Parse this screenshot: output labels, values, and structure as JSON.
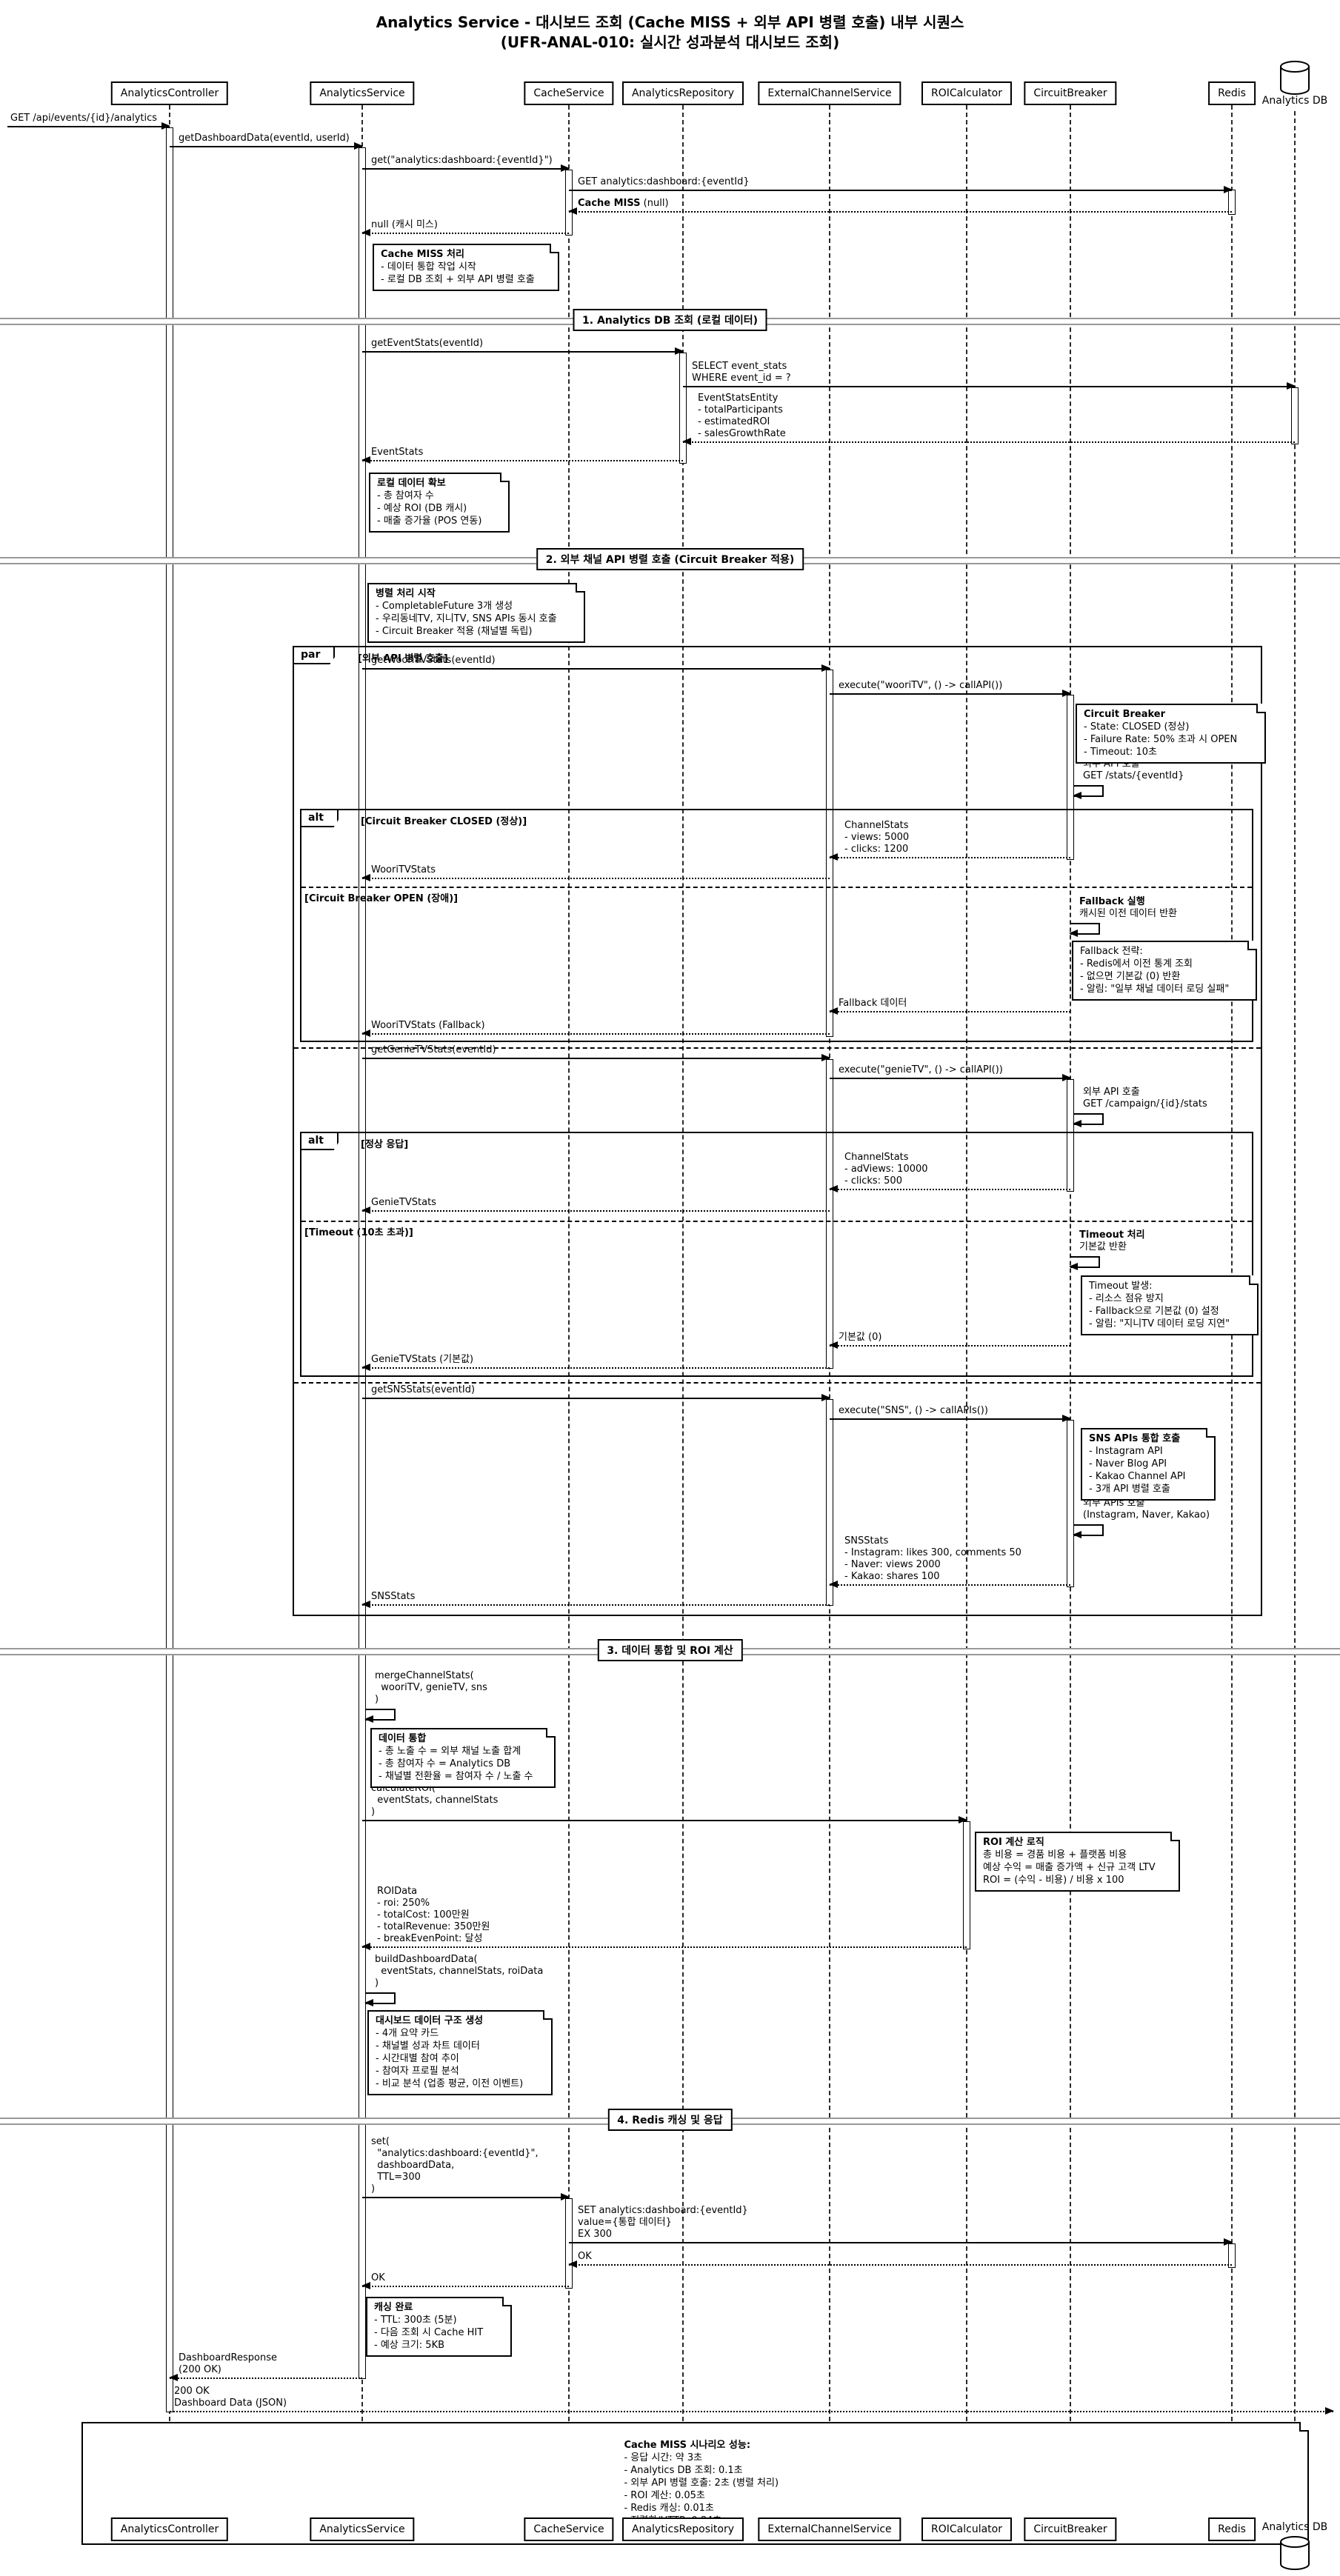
{
  "title": {
    "line1": "Analytics Service - 대시보드 조회 (Cache MISS + 외부 API 병렬 호출) 내부 시퀀스",
    "line2": "(UFR-ANAL-010: 실시간 성과분석 대시보드 조회)"
  },
  "colors": {
    "line": "#000000",
    "divider_line": "#989898",
    "background": "#ffffff"
  },
  "participants": [
    {
      "id": "controller",
      "name": "AnalyticsController"
    },
    {
      "id": "service",
      "name": "AnalyticsService"
    },
    {
      "id": "cache",
      "name": "CacheService"
    },
    {
      "id": "repository",
      "name": "AnalyticsRepository"
    },
    {
      "id": "external",
      "name": "ExternalChannelService"
    },
    {
      "id": "roi",
      "name": "ROICalculator"
    },
    {
      "id": "breaker",
      "name": "CircuitBreaker"
    },
    {
      "id": "redis",
      "name": "Redis"
    },
    {
      "id": "db",
      "name": "Analytics DB",
      "icon": "database-icon"
    }
  ],
  "dividers": {
    "d1": "1. Analytics DB 조회 (로컬 데이터)",
    "d2": "2. 외부 채널 API 병렬 호출 (Circuit Breaker 적용)",
    "d3": "3. 데이터 통합 및 ROI 계산",
    "d4": "4. Redis 캐싱 및 응답"
  },
  "fragments": {
    "par": {
      "keyword": "par",
      "condition": "[외부 API 병렬 호출]"
    },
    "alt_breaker": {
      "keyword": "alt",
      "condition": "[Circuit Breaker CLOSED (정상)]",
      "else_condition": "[Circuit Breaker OPEN (장애)]"
    },
    "alt_timeout": {
      "keyword": "alt",
      "condition": "[정상 응답]",
      "else_condition": "[Timeout (10초 초과)]"
    }
  },
  "messages": {
    "m1": {
      "lines": [
        "GET /api/events/{id}/analytics"
      ]
    },
    "m2": {
      "lines": [
        "getDashboardData(eventId, userId)"
      ]
    },
    "m3": {
      "lines": [
        "get(\"analytics:dashboard:{eventId}\")"
      ]
    },
    "m4": {
      "lines": [
        "GET analytics:dashboard:{eventId}"
      ]
    },
    "m5": {
      "bold": "Cache MISS",
      "rest": " (null)"
    },
    "m6": {
      "lines": [
        "null (캐시 미스)"
      ]
    },
    "m7": {
      "lines": [
        "getEventStats(eventId)"
      ]
    },
    "m8": {
      "lines": [
        "SELECT event_stats",
        "WHERE event_id = ?"
      ]
    },
    "m9": {
      "lines": [
        "EventStatsEntity",
        "- totalParticipants",
        "- estimatedROI",
        "- salesGrowthRate"
      ]
    },
    "m10": {
      "lines": [
        "EventStats"
      ]
    },
    "m11": {
      "lines": [
        "getWooriTVStats(eventId)"
      ]
    },
    "m12": {
      "lines": [
        "execute(\"wooriTV\", () -> callAPI())"
      ]
    },
    "m13": {
      "lines": [
        "외부 API 호출",
        "GET /stats/{eventId}"
      ]
    },
    "m14": {
      "lines": [
        "ChannelStats",
        "- views: 5000",
        "- clicks: 1200"
      ]
    },
    "m15": {
      "lines": [
        "WooriTVStats"
      ]
    },
    "m16": {
      "title": "Fallback 실행",
      "lines": [
        "캐시된 이전 데이터 반환"
      ]
    },
    "m17": {
      "lines": [
        "Fallback 데이터"
      ]
    },
    "m18": {
      "lines": [
        "WooriTVStats (Fallback)"
      ]
    },
    "m19": {
      "lines": [
        "getGenieTVStats(eventId)"
      ]
    },
    "m20": {
      "lines": [
        "execute(\"genieTV\", () -> callAPI())"
      ]
    },
    "m21": {
      "lines": [
        "외부 API 호출",
        "GET /campaign/{id}/stats"
      ]
    },
    "m22": {
      "lines": [
        "ChannelStats",
        "- adViews: 10000",
        "- clicks: 500"
      ]
    },
    "m23": {
      "lines": [
        "GenieTVStats"
      ]
    },
    "m24": {
      "title": "Timeout 처리",
      "lines": [
        "기본값 반환"
      ]
    },
    "m25": {
      "lines": [
        "기본값 (0)"
      ]
    },
    "m26": {
      "lines": [
        "GenieTVStats (기본값)"
      ]
    },
    "m27": {
      "lines": [
        "getSNSStats(eventId)"
      ]
    },
    "m28": {
      "lines": [
        "execute(\"SNS\", () -> callAPIs())"
      ]
    },
    "m29": {
      "lines": [
        "외부 APIs 호출",
        "(Instagram, Naver, Kakao)"
      ]
    },
    "m30": {
      "lines": [
        "SNSStats",
        "- Instagram: likes 300, comments 50",
        "- Naver: views 2000",
        "- Kakao: shares 100"
      ]
    },
    "m31": {
      "lines": [
        "SNSStats"
      ]
    },
    "m32": {
      "lines": [
        "mergeChannelStats(",
        "  wooriTV, genieTV, sns",
        ")"
      ]
    },
    "m33": {
      "lines": [
        "calculateROI(",
        "  eventStats, channelStats",
        ")"
      ]
    },
    "m34": {
      "lines": [
        "ROIData",
        "- roi: 250%",
        "- totalCost: 100만원",
        "- totalRevenue: 350만원",
        "- breakEvenPoint: 달성"
      ]
    },
    "m35": {
      "lines": [
        "buildDashboardData(",
        "  eventStats, channelStats, roiData",
        ")"
      ]
    },
    "m36": {
      "lines": [
        "set(",
        "  \"analytics:dashboard:{eventId}\",",
        "  dashboardData,",
        "  TTL=300",
        ")"
      ]
    },
    "m37": {
      "lines": [
        "SET analytics:dashboard:{eventId}",
        "value={통합 데이터}",
        "EX 300"
      ]
    },
    "m38": {
      "lines": [
        "OK"
      ]
    },
    "m39": {
      "lines": [
        "OK"
      ]
    },
    "m40": {
      "lines": [
        "DashboardResponse",
        "(200 OK)"
      ]
    },
    "m41": {
      "lines": [
        "200 OK",
        "Dashboard Data (JSON)"
      ]
    }
  },
  "notes": {
    "n1": {
      "title": "Cache MISS 처리",
      "lines": [
        "- 데이터 통합 작업 시작",
        "- 로컬 DB 조회 + 외부 API 병렬 호출"
      ]
    },
    "n2": {
      "title": "로컬 데이터 확보",
      "lines": [
        "- 총 참여자 수",
        "- 예상 ROI (DB 캐시)",
        "- 매출 증가율 (POS 연동)"
      ]
    },
    "n3": {
      "title": "병렬 처리 시작",
      "lines": [
        "- CompletableFuture 3개 생성",
        "- 우리동네TV, 지니TV, SNS APIs 동시 호출",
        "- Circuit Breaker 적용 (채널별 독립)"
      ]
    },
    "n4": {
      "title": "Circuit Breaker",
      "lines": [
        "- State: CLOSED (정상)",
        "- Failure Rate: 50% 초과 시 OPEN",
        "- Timeout: 10초"
      ]
    },
    "n5": {
      "lines": [
        "Fallback 전략:",
        "- Redis에서 이전 통계 조회",
        "- 없으면 기본값 (0) 반환",
        "- 알림: \"일부 채널 데이터 로딩 실패\""
      ]
    },
    "n6": {
      "lines": [
        "Timeout 발생:",
        "- 리소스 점유 방지",
        "- Fallback으로 기본값 (0) 설정",
        "- 알림: \"지니TV 데이터 로딩 지연\""
      ]
    },
    "n7": {
      "title": "SNS APIs 통합 호출",
      "lines": [
        "- Instagram API",
        "- Naver Blog API",
        "- Kakao Channel API",
        "- 3개 API 병렬 호출"
      ]
    },
    "n8": {
      "title": "데이터 통합",
      "lines": [
        "- 총 노출 수 = 외부 채널 노출 합계",
        "- 총 참여자 수 = Analytics DB",
        "- 채널별 전환율 = 참여자 수 / 노출 수"
      ]
    },
    "n9": {
      "title": "ROI 계산 로직",
      "lines": [
        "총 비용 = 경품 비용 + 플랫폼 비용",
        "예상 수익 = 매출 증가액 + 신규 고객 LTV",
        "ROI = (수익 - 비용) / 비용 x 100"
      ]
    },
    "n10": {
      "title": "대시보드 데이터 구조 생성",
      "lines": [
        "- 4개 요약 카드",
        "- 채널별 성과 차트 데이터",
        "- 시간대별 참여 추이",
        "- 참여자 프로필 분석",
        "- 비교 분석 (업종 평균, 이전 이벤트)"
      ]
    },
    "n11": {
      "title": "캐싱 완료",
      "lines": [
        "- TTL: 300초 (5분)",
        "- 다음 조회 시 Cache HIT",
        "- 예상 크기: 5KB"
      ]
    },
    "n12": {
      "title": "Cache MISS 시나리오 성능:",
      "lines": [
        "- 응답 시간: 약 3초",
        "- Analytics DB 조회: 0.1초",
        "- 외부 API 병렬 호출: 2초 (병렬 처리)",
        "- ROI 계산: 0.05초",
        "- Redis 캐싱: 0.01초",
        "- 직렬화/HTTP: 0.84초"
      ]
    }
  }
}
